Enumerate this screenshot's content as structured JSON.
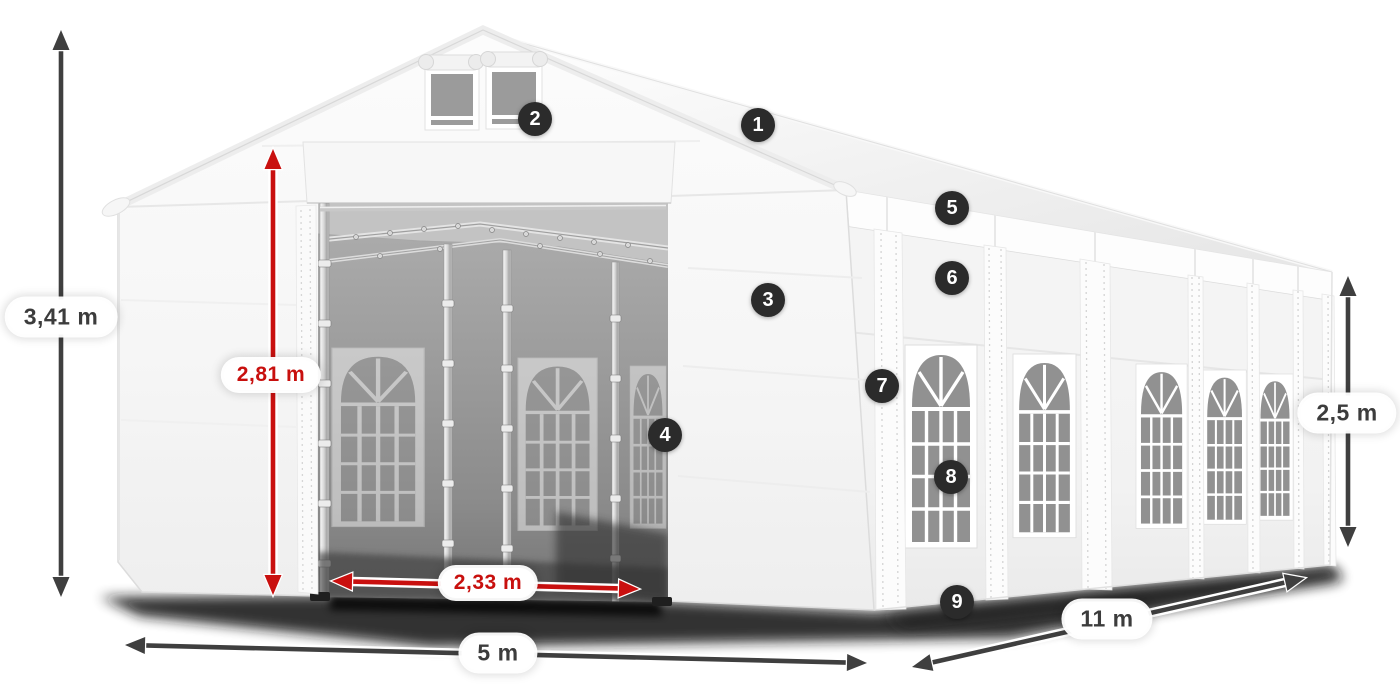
{
  "colors": {
    "arrow_dark": "#3f3f3f",
    "arrow_red": "#c9100f",
    "label_text_dark": "#3c3c3c",
    "label_text_red": "#c8100e",
    "badge_bg": "#2b2b2b",
    "badge_text": "#ffffff",
    "canvas_white": "#f6f6f6",
    "interior_gray": "#9a9a9a"
  },
  "dimensions": [
    {
      "id": "total-height",
      "label": "3,41 m",
      "color": "dark",
      "orientation": "vertical",
      "x": 61,
      "y1": 30,
      "y2": 597,
      "label_x": 61,
      "label_y": 317
    },
    {
      "id": "entrance-height",
      "label": "2,81 m",
      "color": "red",
      "orientation": "vertical",
      "x": 273,
      "y1": 149,
      "y2": 595,
      "label_x": 271,
      "label_y": 375
    },
    {
      "id": "entrance-width",
      "label": "2,33 m",
      "color": "red",
      "orientation": "horizontal",
      "x1": 332,
      "y1": 581,
      "x2": 639,
      "y2": 589,
      "label_x": 488,
      "label_y": 583
    },
    {
      "id": "front-width",
      "label": "5 m",
      "color": "dark",
      "orientation": "horizontal",
      "x1": 125,
      "y1": 645,
      "x2": 867,
      "y2": 663,
      "label_x": 498,
      "label_y": 653
    },
    {
      "id": "side-length",
      "label": "11 m",
      "color": "dark",
      "orientation": "horizontal",
      "x1": 912,
      "y1": 667,
      "x2": 1305,
      "y2": 578,
      "label_x": 1107,
      "label_y": 619
    },
    {
      "id": "side-height",
      "label": "2,5 m",
      "color": "dark",
      "orientation": "vertical",
      "x": 1348,
      "y1": 276,
      "y2": 547,
      "label_x": 1347,
      "label_y": 413
    }
  ],
  "callouts": [
    {
      "number": "1",
      "x": 758,
      "y": 125
    },
    {
      "number": "2",
      "x": 535,
      "y": 119
    },
    {
      "number": "3",
      "x": 768,
      "y": 300
    },
    {
      "number": "4",
      "x": 665,
      "y": 435
    },
    {
      "number": "5",
      "x": 952,
      "y": 208
    },
    {
      "number": "6",
      "x": 952,
      "y": 278
    },
    {
      "number": "7",
      "x": 882,
      "y": 386
    },
    {
      "number": "8",
      "x": 951,
      "y": 477
    },
    {
      "number": "9",
      "x": 957,
      "y": 602
    }
  ]
}
